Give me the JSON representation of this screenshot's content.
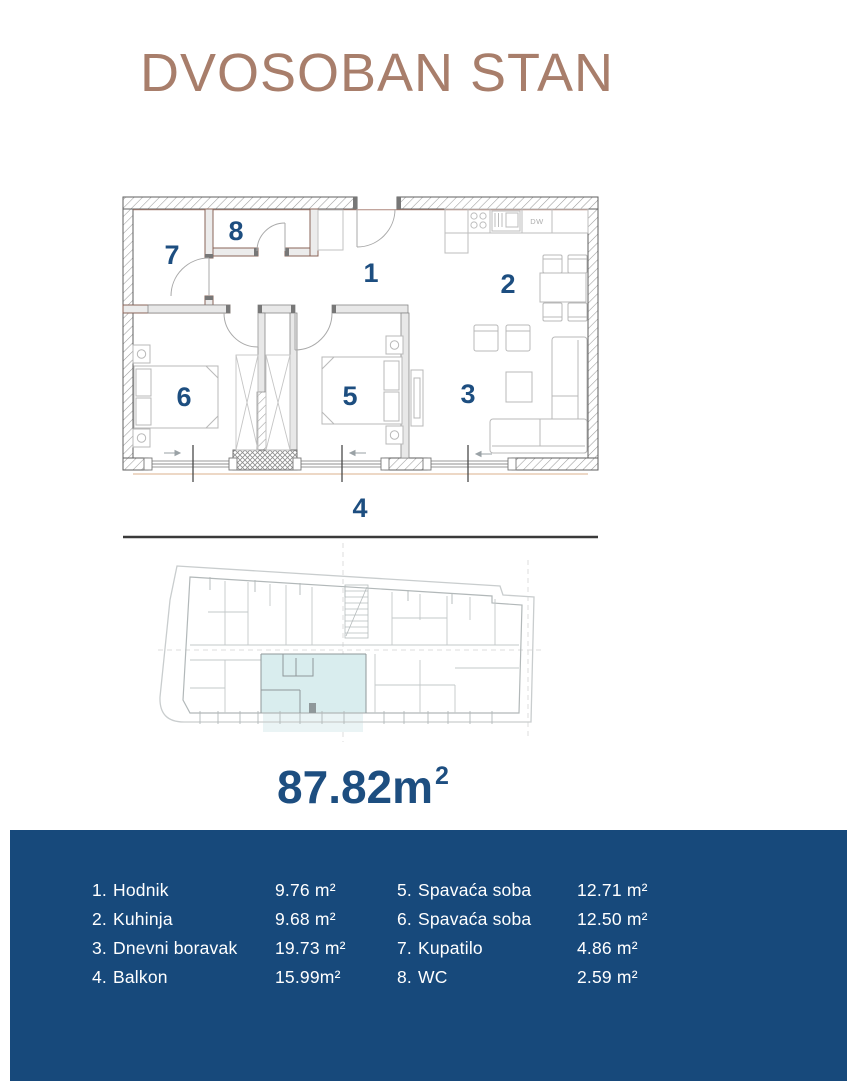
{
  "title": "DVOSOBAN STAN",
  "area_label": {
    "value": "87.82m",
    "sup": "2"
  },
  "plan": {
    "room_labels": {
      "hodnik": "1",
      "kuhinja": "2",
      "dnevni_boravak": "3",
      "balkon": "4",
      "spavaca_soba_1": "5",
      "spavaca_soba_2": "6",
      "kupatilo": "7",
      "wc": "8"
    },
    "kitchen_dw_label": "DW"
  },
  "legend": {
    "items": [
      {
        "num": "1.",
        "label": "Hodnik",
        "area": "9.76 m²"
      },
      {
        "num": "2.",
        "label": "Kuhinja",
        "area": "9.68 m²"
      },
      {
        "num": "3.",
        "label": "Dnevni boravak",
        "area": "19.73 m²"
      },
      {
        "num": "4.",
        "label": "Balkon",
        "area": "15.99m²"
      },
      {
        "num": "5.",
        "label": "Spavaća soba",
        "area": "12.71 m²"
      },
      {
        "num": "6.",
        "label": "Spavaća soba",
        "area": "12.50 m²"
      },
      {
        "num": "7.",
        "label": "Kupatilo",
        "area": "4.86 m²"
      },
      {
        "num": "8.",
        "label": "WC",
        "area": "2.59 m²"
      }
    ]
  },
  "colors": {
    "title_brown": "#A87E6B",
    "accent_blue": "#1D4E80",
    "footer_bg": "#17497B",
    "unit_highlight": "#D9EDEE",
    "balcony_line": "#E2C0A4"
  }
}
